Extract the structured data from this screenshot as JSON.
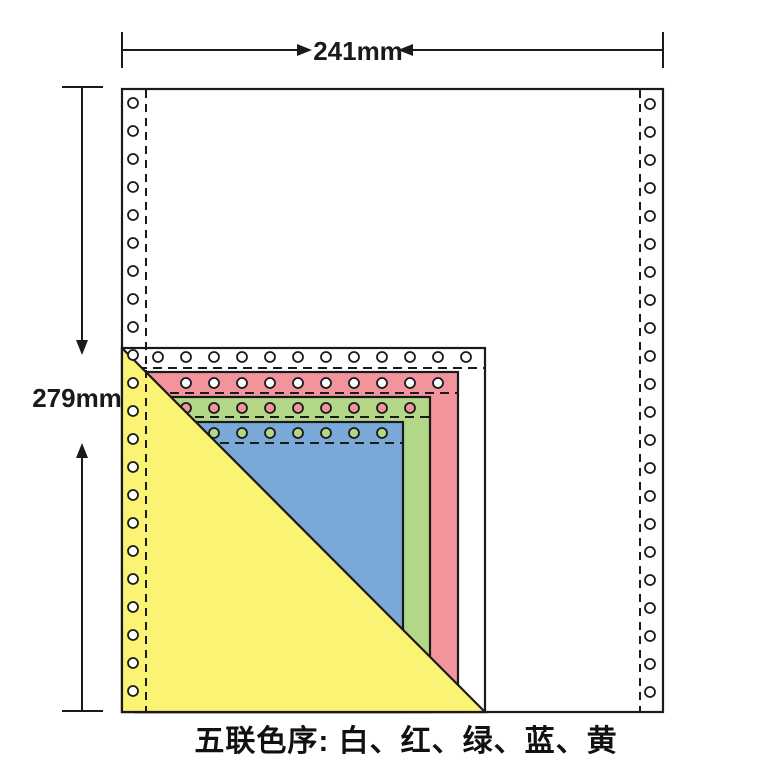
{
  "dimension_labels": {
    "width": "241mm",
    "height": "279mm"
  },
  "caption": "五联色序: 白、红、绿、蓝、黄",
  "colors": {
    "outline": "#1a1a1a",
    "paper_white": "#ffffff",
    "red": "#f2949c",
    "green": "#b2d787",
    "blue": "#7aa9d8",
    "yellow": "#fbf374"
  },
  "plies": [
    {
      "order": 1,
      "label": "白",
      "color_key": "paper_white"
    },
    {
      "order": 2,
      "label": "红",
      "color_key": "red"
    },
    {
      "order": 3,
      "label": "绿",
      "color_key": "green"
    },
    {
      "order": 4,
      "label": "蓝",
      "color_key": "blue"
    },
    {
      "order": 5,
      "label": "黄",
      "color_key": "yellow"
    }
  ]
}
